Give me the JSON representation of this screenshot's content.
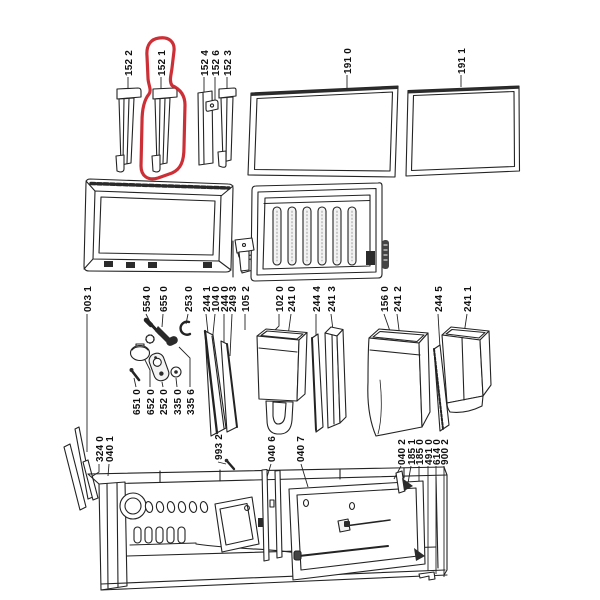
{
  "diagram": {
    "kind": "appliance exploded parts diagram",
    "background": "#ffffff",
    "line_color": "#232323",
    "highlight": {
      "highlighted_label": "152 1",
      "color": "#c9252b",
      "shape": "freehand circle"
    }
  },
  "labels": [
    {
      "text": "152 2"
    },
    {
      "text": "152 1"
    },
    {
      "text": "152 4"
    },
    {
      "text": "152 6"
    },
    {
      "text": "152 3"
    },
    {
      "text": "191 0"
    },
    {
      "text": "191 1"
    },
    {
      "text": "003 1"
    },
    {
      "text": "554 0"
    },
    {
      "text": "655 0"
    },
    {
      "text": "253 0"
    },
    {
      "text": "244 1"
    },
    {
      "text": "104 0"
    },
    {
      "text": "244 0"
    },
    {
      "text": "249 3"
    },
    {
      "text": "105 2"
    },
    {
      "text": "102 0"
    },
    {
      "text": "241 0"
    },
    {
      "text": "244 4"
    },
    {
      "text": "241 3"
    },
    {
      "text": "156 0"
    },
    {
      "text": "241 2"
    },
    {
      "text": "244 5"
    },
    {
      "text": "241 1"
    },
    {
      "text": "651 0"
    },
    {
      "text": "652 0"
    },
    {
      "text": "252 0"
    },
    {
      "text": "335 0"
    },
    {
      "text": "335 6"
    },
    {
      "text": "324 0"
    },
    {
      "text": "040 1"
    },
    {
      "text": "993 2"
    },
    {
      "text": "040 6"
    },
    {
      "text": "040 7"
    },
    {
      "text": "040 2"
    },
    {
      "text": "185 1"
    },
    {
      "text": "185 0"
    },
    {
      "text": "491 0"
    },
    {
      "text": "614 0"
    },
    {
      "text": "900 2"
    }
  ]
}
